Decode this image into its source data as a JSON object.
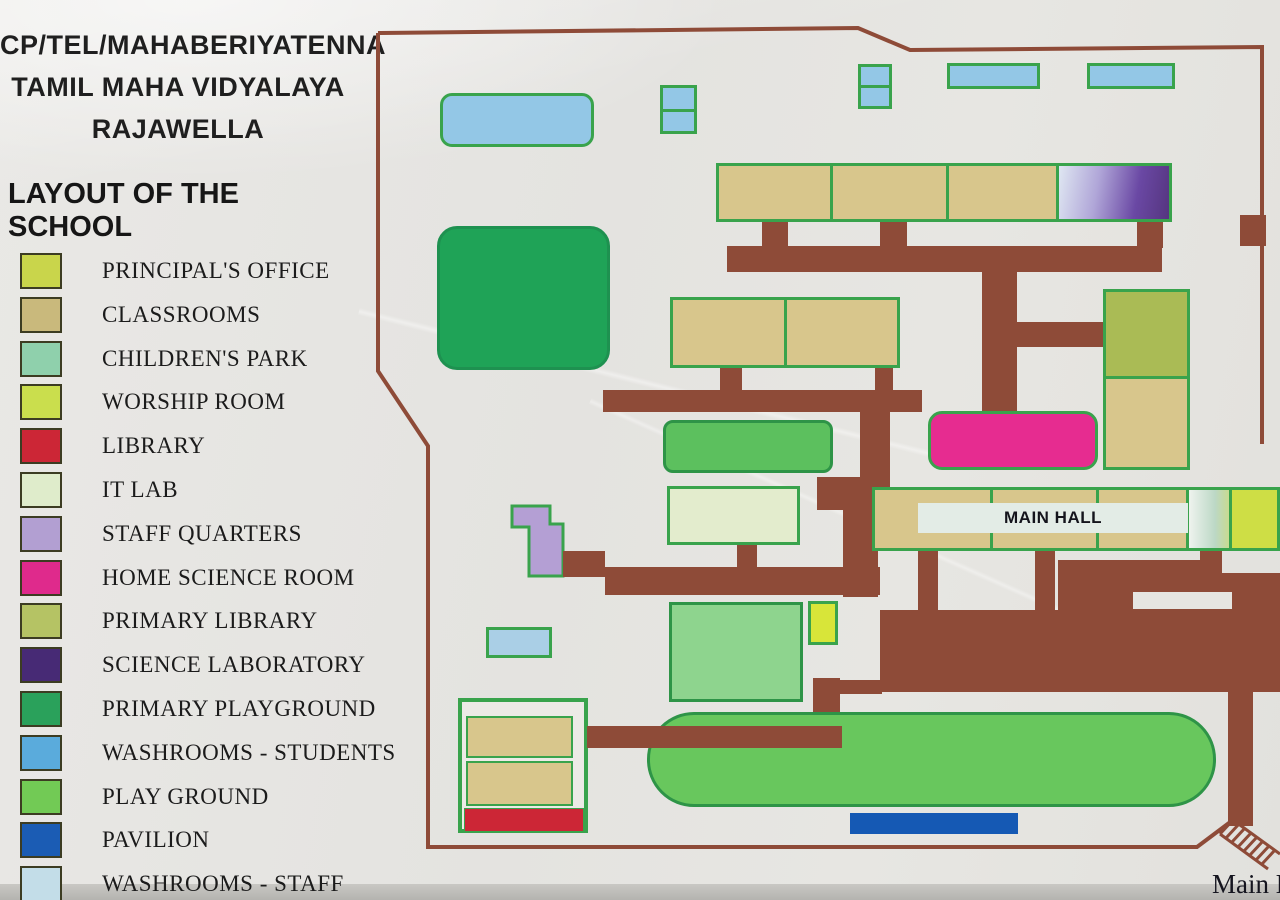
{
  "header": {
    "school_id_line": "CP/TEL/MAHABERIYATENNA",
    "school_name_line": "TAMIL MAHA VIDYALAYA",
    "school_town_line": "RAJAWELLA",
    "map_title": "LAYOUT OF THE SCHOOL"
  },
  "legend": {
    "items": [
      {
        "label": "PRINCIPAL'S OFFICE",
        "color": "#c9d54b"
      },
      {
        "label": "CLASSROOMS",
        "color": "#c9b97c"
      },
      {
        "label": "CHILDREN'S PARK",
        "color": "#8fd0ac"
      },
      {
        "label": "WORSHIP ROOM",
        "color": "#cade4d"
      },
      {
        "label": "LIBRARY",
        "color": "#cc2636"
      },
      {
        "label": "IT LAB",
        "color": "#dfeccb"
      },
      {
        "label": "STAFF QUARTERS",
        "color": "#b29fd2"
      },
      {
        "label": "HOME SCIENCE ROOM",
        "color": "#df2a8c"
      },
      {
        "label": "PRIMARY LIBRARY",
        "color": "#b5c364"
      },
      {
        "label": "SCIENCE LABORATORY",
        "color": "#472a75"
      },
      {
        "label": "PRIMARY PLAYGROUND",
        "color": "#2aa15b"
      },
      {
        "label": "WASHROOMS - STUDENTS",
        "color": "#5aabdc"
      },
      {
        "label": "PLAY GROUND",
        "color": "#72ca55"
      },
      {
        "label": "PAVILION",
        "color": "#1b5cb4"
      },
      {
        "label": "WASHROOMS - STAFF",
        "color": "#c3dde8"
      }
    ]
  },
  "map": {
    "labels": {
      "main_hall": "MAIN HALL",
      "main_entrance_partial": "Main E"
    },
    "palette": {
      "path_brown": "#8e4b38",
      "building_border_green": "#39a34c",
      "classroom_tan": "#d8c68c",
      "washroom_blue": "#93c7e6",
      "washroom_staff_pale": "#aacfe6",
      "primary_playground_green": "#1fa357",
      "play_ground_green": "#68c75d",
      "play_ground_small_green": "#5cc05e",
      "childrens_park_green": "#8ed48e",
      "it_lab_pale": "#e3eccd",
      "worship_yellow": "#d8e539",
      "principals_yellow": "#cede45",
      "library_red": "#cc2636",
      "home_science_pink": "#e62c90",
      "primary_library_olive": "#aabb55",
      "pavilion_blue": "#1559b4",
      "main_hall_banner": "#e3ece6"
    }
  }
}
